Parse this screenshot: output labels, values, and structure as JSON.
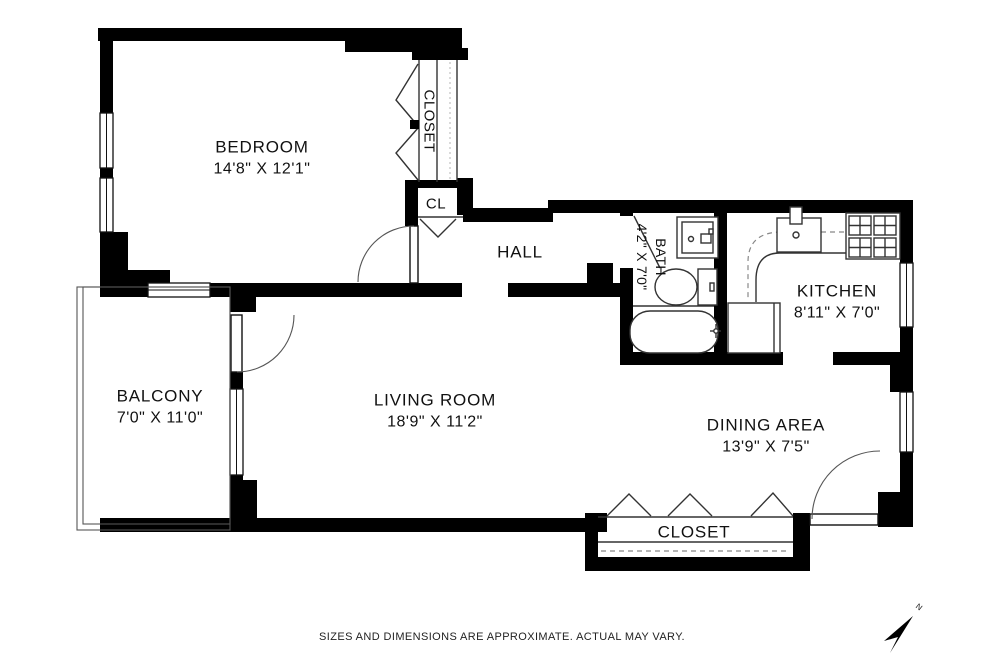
{
  "page": {
    "footer": {
      "disclaimer": "SIZES AND DIMENSIONS ARE APPROXIMATE. ACTUAL MAY VARY."
    },
    "compass": {
      "label": "N"
    }
  },
  "rooms": {
    "bedroom": {
      "name": "BEDROOM",
      "dims": "14'8\" X 12'1\""
    },
    "bedroom_closet": {
      "name": "CLOSET"
    },
    "hall_closet": {
      "name": "CL"
    },
    "hall": {
      "name": "HALL"
    },
    "bath": {
      "name": "BATH",
      "dims": "4'2\" X 7'0\""
    },
    "kitchen": {
      "name": "KITCHEN",
      "dims": "8'11\" X 7'0\""
    },
    "balcony": {
      "name": "BALCONY",
      "dims": "7'0\" X 11'0\""
    },
    "living_room": {
      "name": "LIVING ROOM",
      "dims": "18'9\" X 11'2\""
    },
    "dining_area": {
      "name": "DINING AREA",
      "dims": "13'9\" X 7'5\""
    },
    "entry_closet": {
      "name": "CLOSET"
    }
  },
  "colors": {
    "wall": "#000000",
    "background": "#ffffff",
    "line": "#333333"
  }
}
